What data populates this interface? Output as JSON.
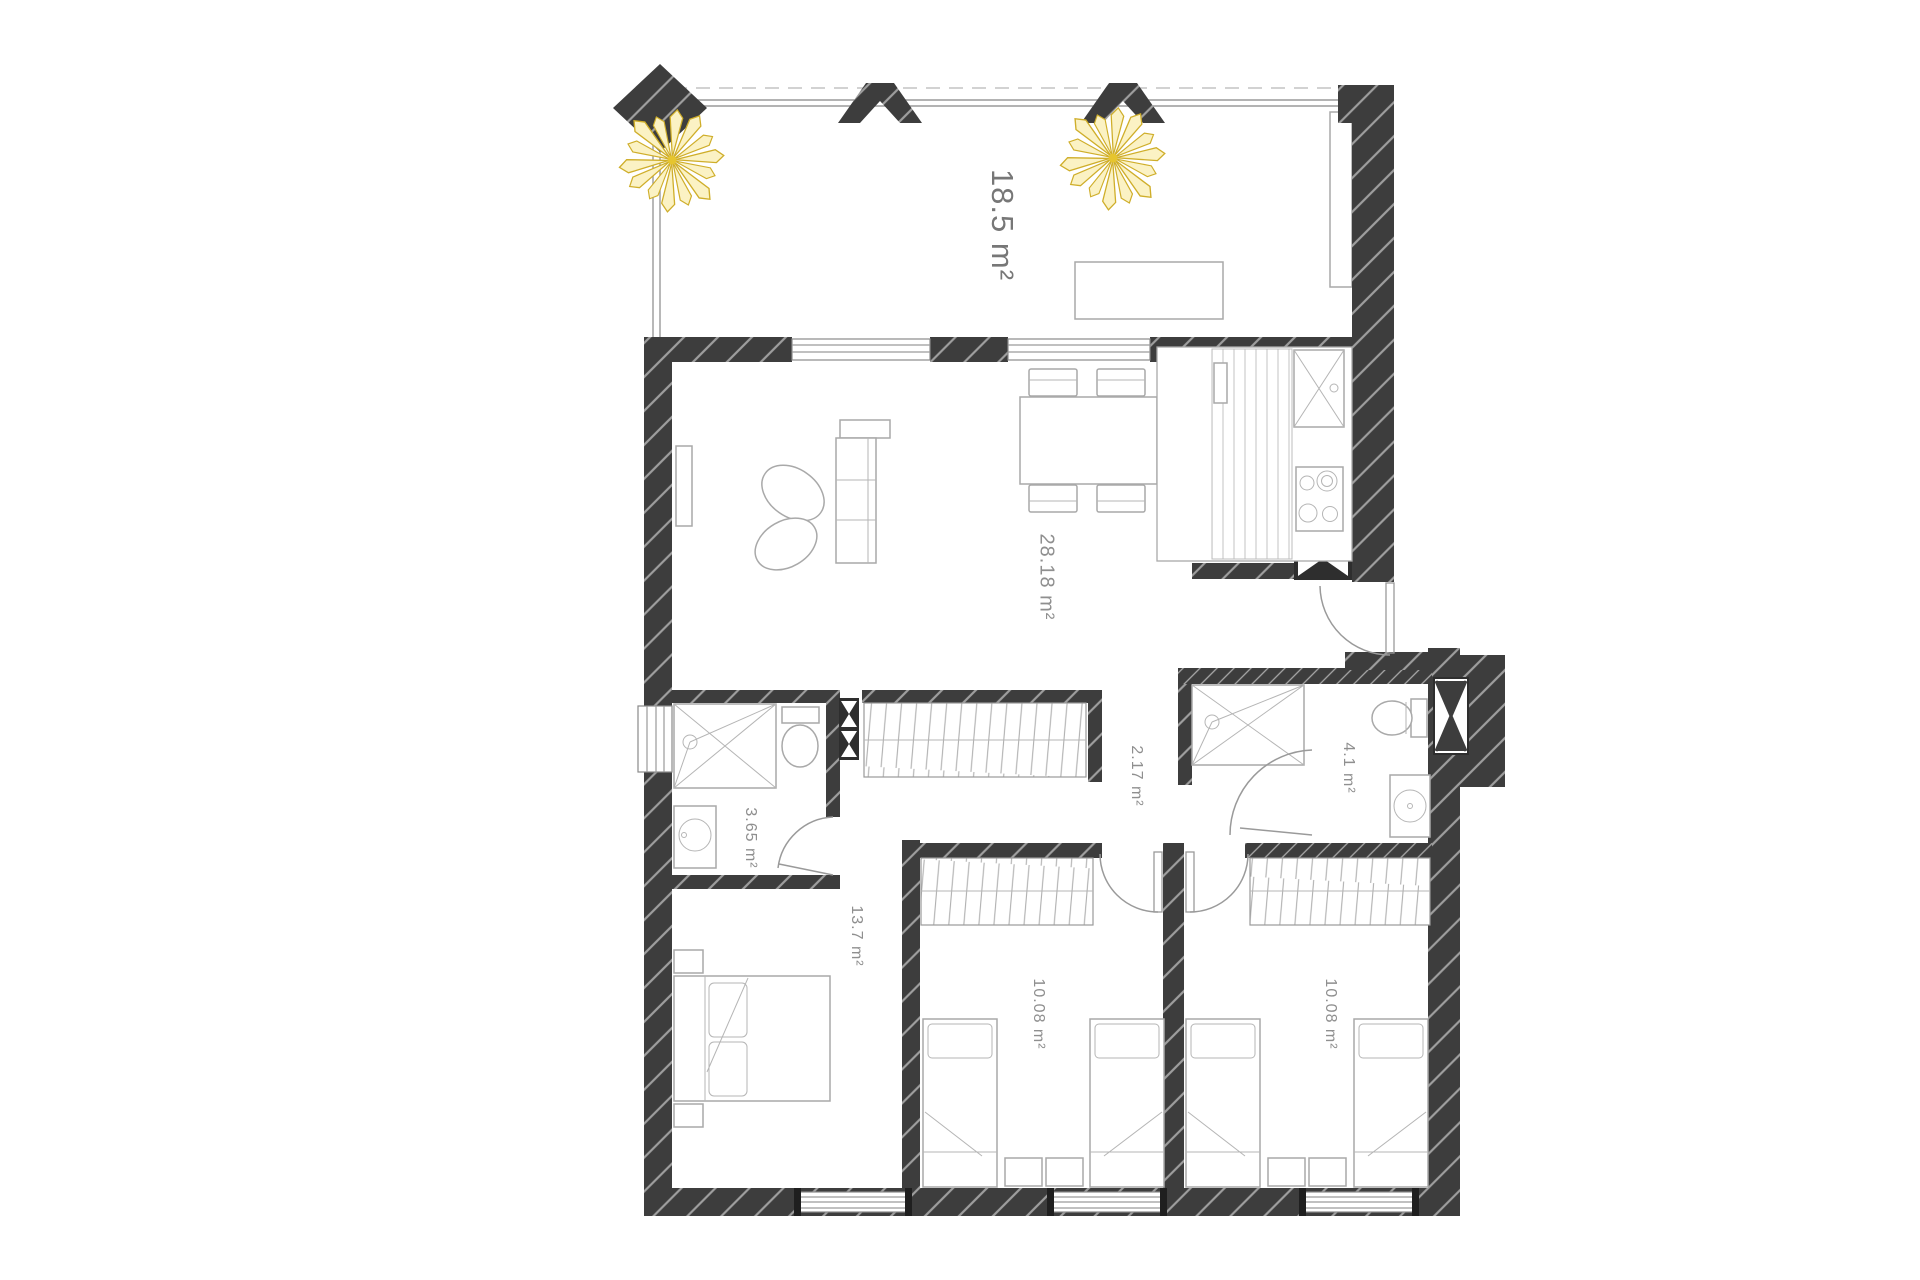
{
  "title": "Apartment floor plan",
  "rooms": [
    {
      "id": "terrace",
      "area_label": "18.5 m²"
    },
    {
      "id": "living-dining",
      "area_label": "28.18 m²"
    },
    {
      "id": "hallway",
      "area_label": "2.17 m²"
    },
    {
      "id": "bathroom-left",
      "area_label": "3.65 m²"
    },
    {
      "id": "bathroom-right",
      "area_label": "4.1 m²"
    },
    {
      "id": "bedroom-left",
      "area_label": "13.7 m²"
    },
    {
      "id": "bedroom-middle",
      "area_label": "10.08 m²"
    },
    {
      "id": "bedroom-right",
      "area_label": "10.08 m²"
    }
  ],
  "colors": {
    "wall": "#3d3d3d",
    "wall_hatch": "#ffffff",
    "label_text": "#8f8f8f",
    "palm": "#d9b92c",
    "furniture_line": "#a9a9a9",
    "background": "#ffffff"
  }
}
